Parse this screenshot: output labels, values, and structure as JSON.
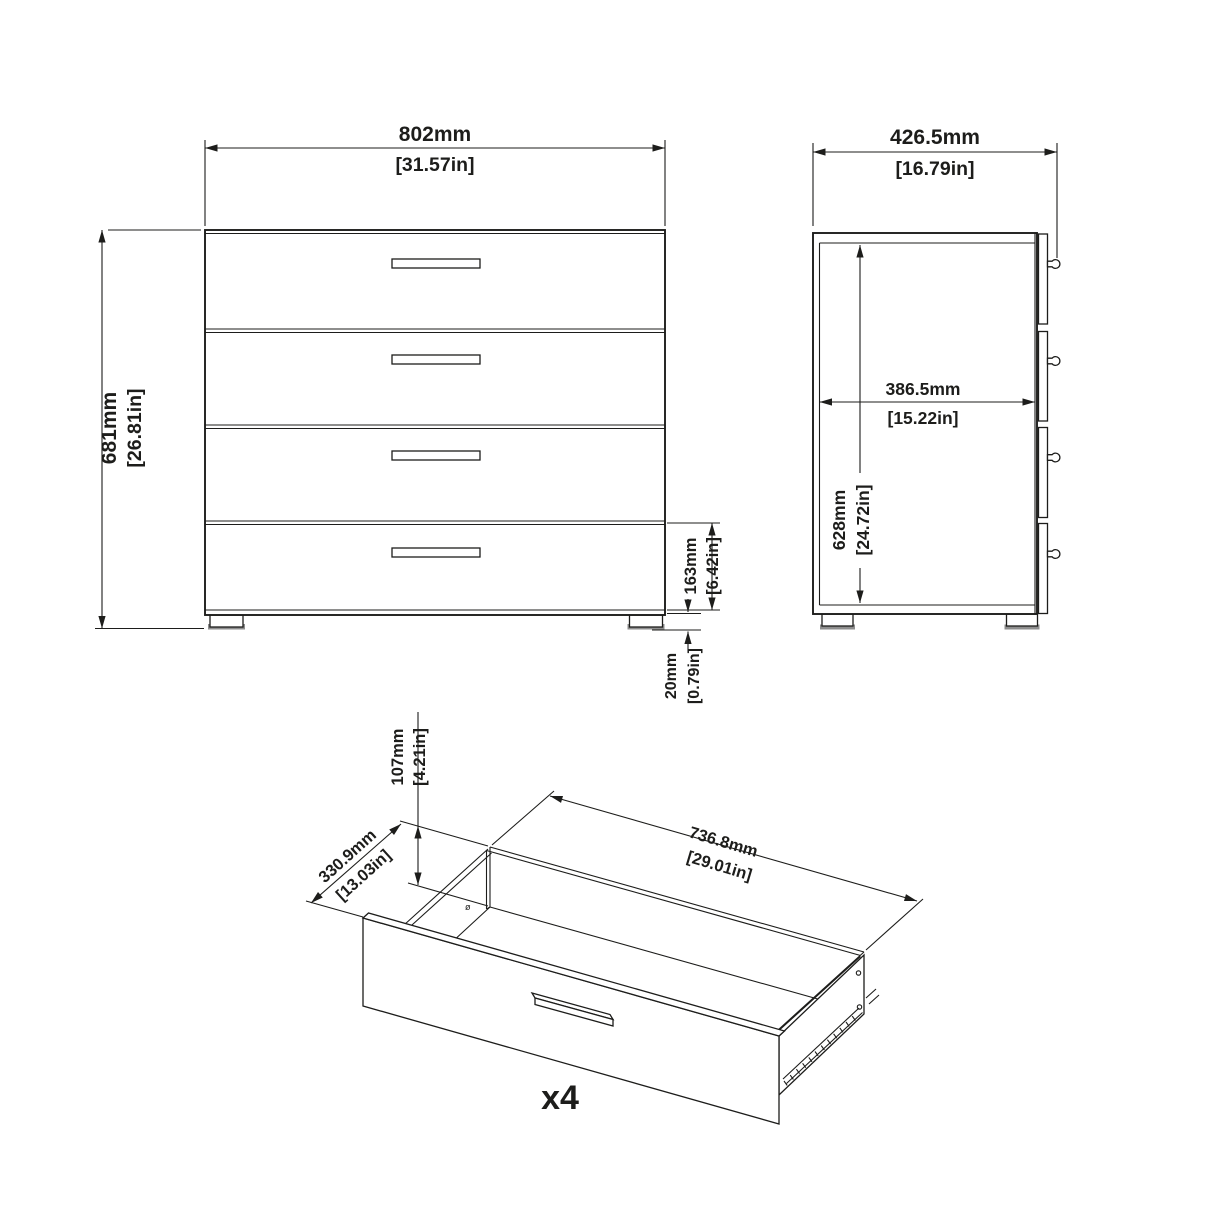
{
  "front_view": {
    "width_mm": "802mm",
    "width_in": "[31.57in]",
    "height_mm": "681mm",
    "height_in": "[26.81in]",
    "drawer_front_height_mm": "163mm",
    "drawer_front_height_in": "[6.42in]",
    "foot_height_mm": "20mm",
    "foot_height_in": "[0.79in]"
  },
  "side_view": {
    "depth_mm": "426.5mm",
    "depth_in": "[16.79in]",
    "interior_depth_mm": "386.5mm",
    "interior_depth_in": "[15.22in]",
    "interior_height_mm": "628mm",
    "interior_height_in": "[24.72in]"
  },
  "drawer_view": {
    "inner_height_mm": "107mm",
    "inner_height_in": "[4.21in]",
    "depth_mm": "330.9mm",
    "depth_in": "[13.03in]",
    "width_mm": "736.8mm",
    "width_in": "[29.01in]",
    "quantity_label": "x4",
    "screw_symbol": "ø"
  },
  "colors": {
    "line": "#1d1d1b",
    "background": "#ffffff",
    "foot_shade": "#8e8e8e"
  }
}
